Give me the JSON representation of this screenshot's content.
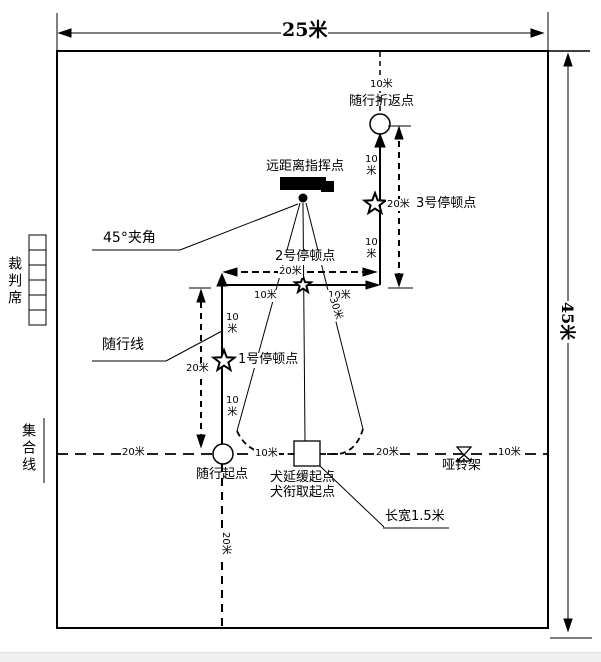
{
  "dimensions": {
    "field_width": "25米",
    "field_height": "45米"
  },
  "measurements": {
    "m10": "10米",
    "m10_stacked": "10\n米",
    "m20": "20米",
    "m30": "30米"
  },
  "labels": {
    "judges_seat": "裁判席",
    "assembly_line": "集合线",
    "turnback_point": "随行折返点",
    "remote_command_point": "远距离指挥点",
    "stop_point_3": "3号停顿点",
    "stop_point_2": "2号停顿点",
    "stop_point_1": "1号停顿点",
    "angle_45": "45°夹角",
    "heeling_line": "随行线",
    "heeling_start": "随行起点",
    "dog_delay_start": "犬延缓起点",
    "dog_fetch_start": "犬衔取起点",
    "dumbbell_rack": "哑铃架",
    "box_size": "长宽1.5米"
  },
  "colors": {
    "line": "#000000",
    "background": "#ffffff"
  }
}
